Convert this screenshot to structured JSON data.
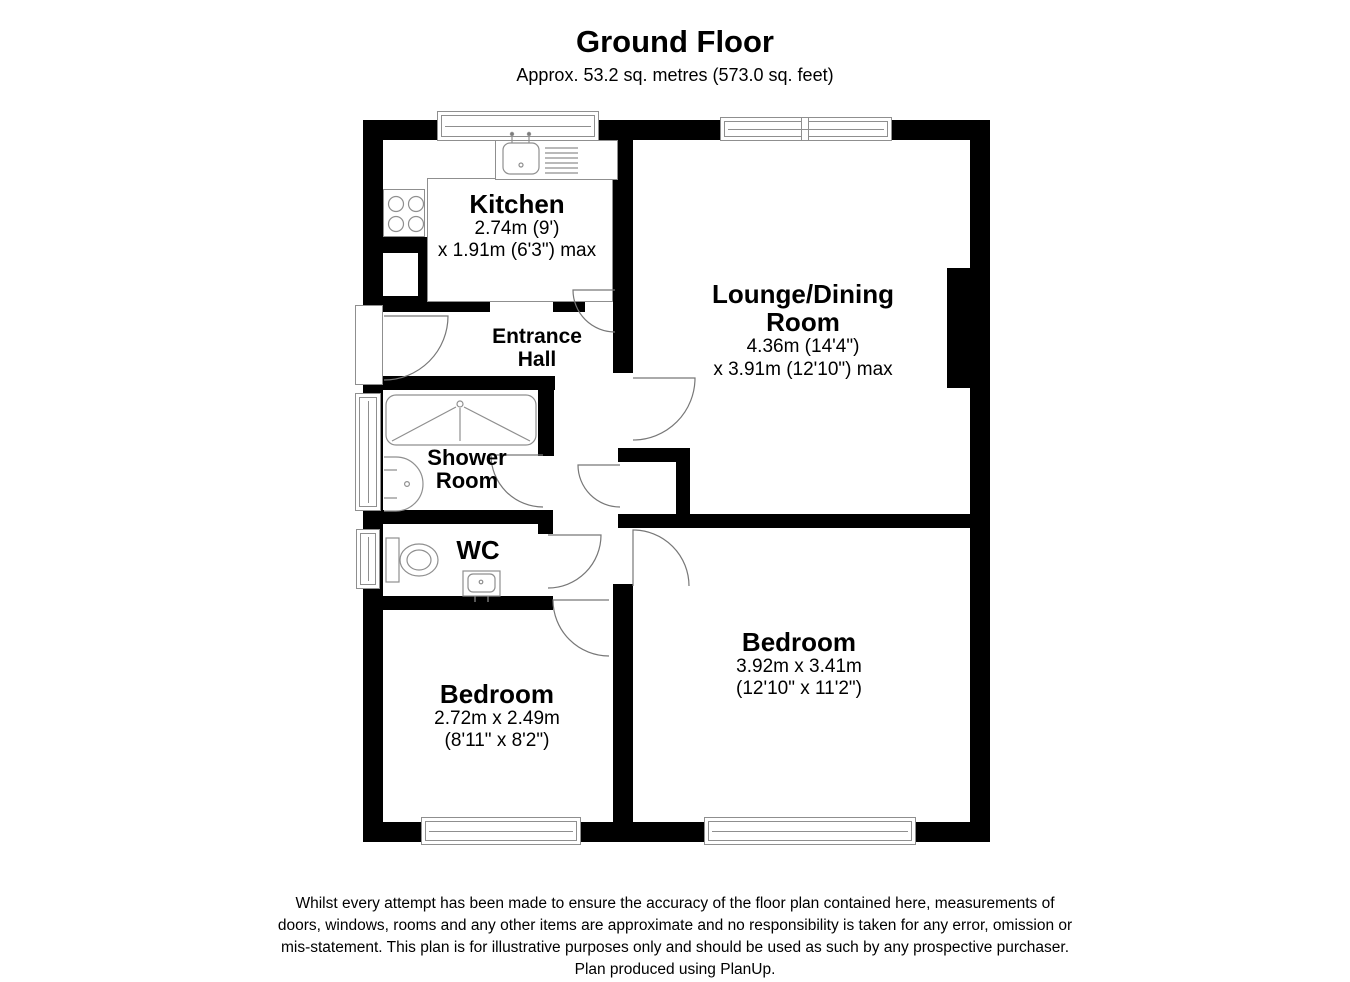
{
  "header": {
    "title": "Ground Floor",
    "subtitle": "Approx. 53.2 sq. metres (573.0 sq. feet)"
  },
  "rooms": {
    "kitchen": {
      "name": "Kitchen",
      "dim1": "2.74m (9')",
      "dim2": "x 1.91m (6'3\") max"
    },
    "lounge": {
      "name_line1": "Lounge/Dining",
      "name_line2": "Room",
      "dim1": "4.36m (14'4\")",
      "dim2": "x 3.91m (12'10\") max"
    },
    "entrance_hall": {
      "name_line1": "Entrance",
      "name_line2": "Hall"
    },
    "shower_room": {
      "name_line1": "Shower",
      "name_line2": "Room"
    },
    "wc": {
      "name": "WC"
    },
    "bedroom_small": {
      "name": "Bedroom",
      "dim1": "2.72m x 2.49m",
      "dim2": "(8'11\" x 8'2\")"
    },
    "bedroom_large": {
      "name": "Bedroom",
      "dim1": "3.92m x 3.41m",
      "dim2": "(12'10\" x 11'2\")"
    }
  },
  "fixtures": {
    "sink": "kitchen sink with taps",
    "drainer": "draining board",
    "hob": "4-ring hob",
    "shower_tray": "shower/bath tray",
    "wash_basin": "wash basin",
    "toilet": "toilet",
    "wc_basin": "small basin",
    "chimney_breast": "chimney breast",
    "windows": "double-line window symbols",
    "doors": "quarter-arc door swing symbols"
  },
  "colors": {
    "wall": "#000000",
    "fixture_outline": "#8f8f8f",
    "door_arc": "#777777",
    "background": "#ffffff",
    "text": "#000000"
  },
  "disclaimer": {
    "lines": [
      "Whilst every attempt has been made to ensure the accuracy of the floor plan contained here, measurements of",
      "doors, windows, rooms and any other items are approximate and no responsibility is taken for any error, omission or",
      "mis-statement. This plan is for illustrative purposes only and should be used as such by any prospective purchaser.",
      "Plan produced using PlanUp."
    ]
  }
}
